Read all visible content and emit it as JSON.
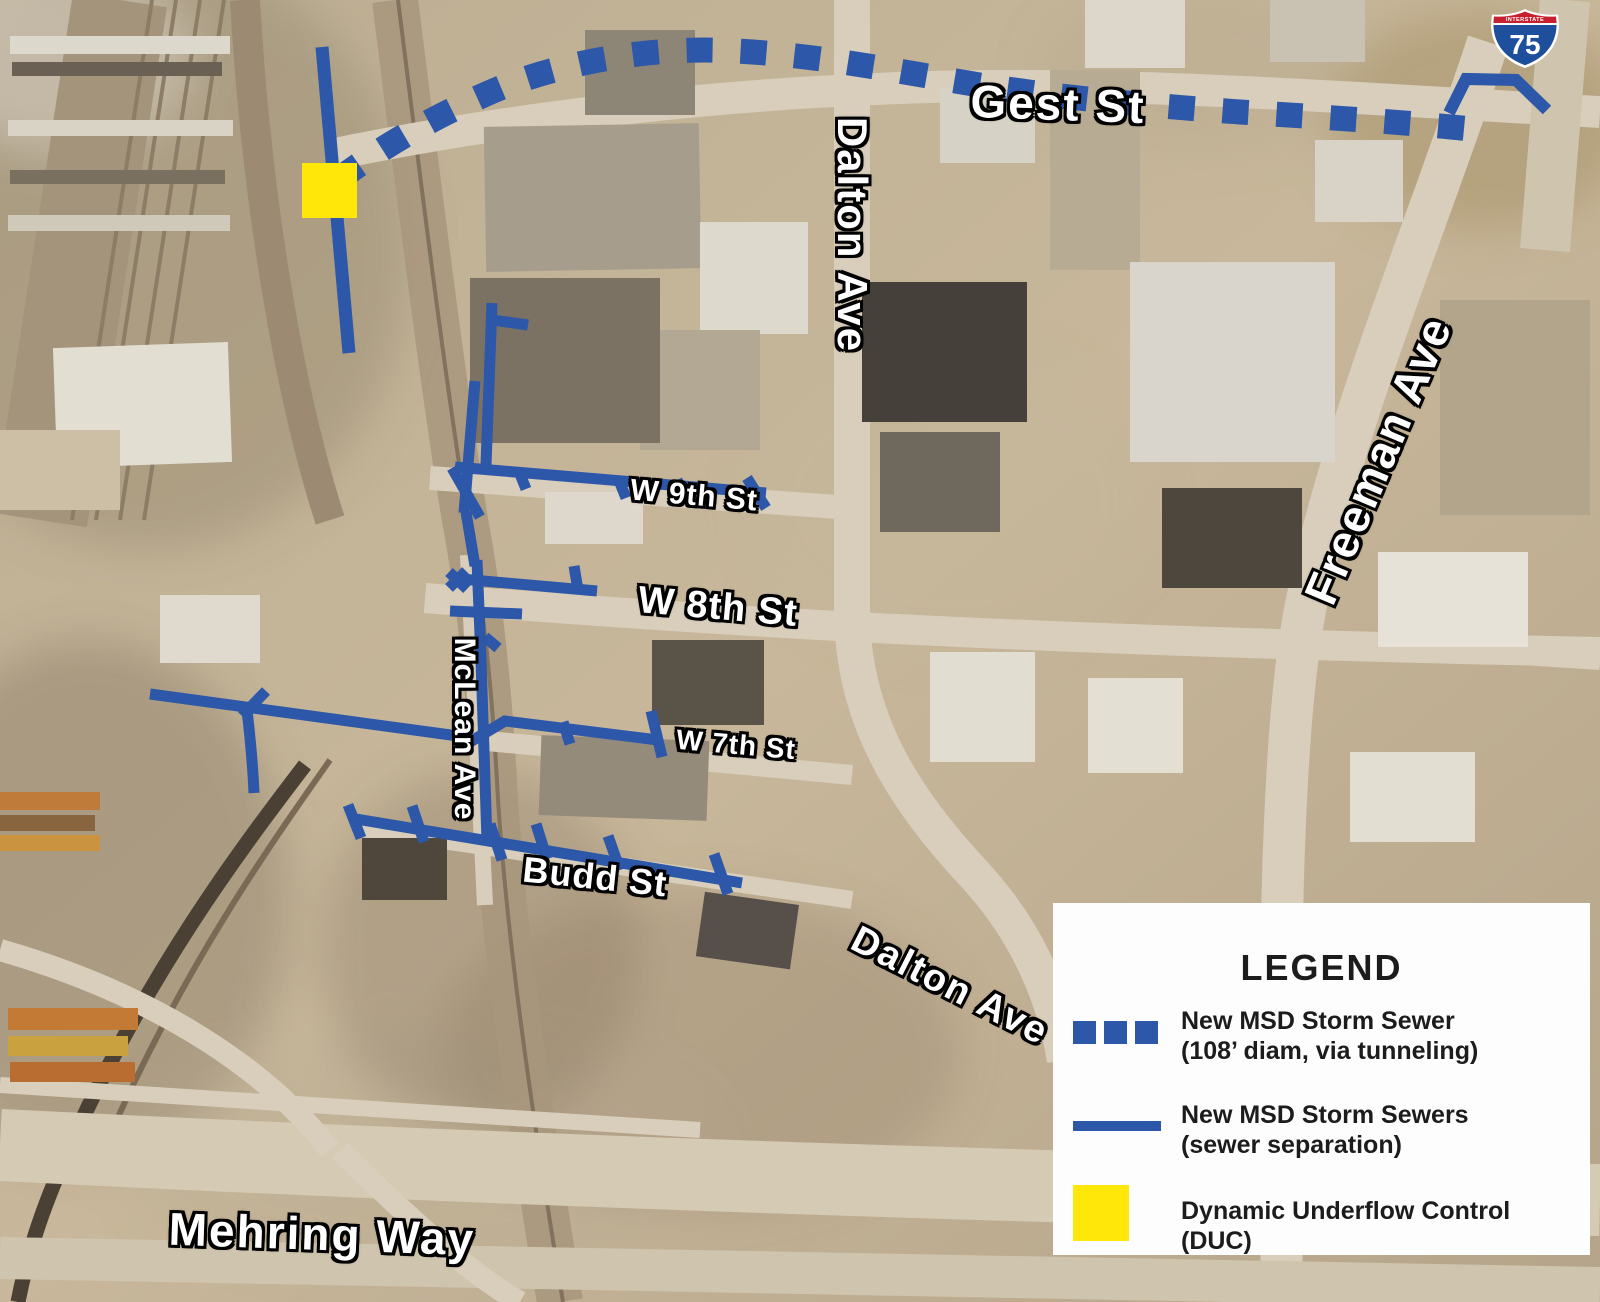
{
  "map": {
    "street_labels": {
      "gest_st": "Gest St",
      "dalton_ave_north": "Dalton Ave",
      "freeman_ave": "Freeman Ave",
      "w_9th_st": "W 9th St",
      "w_8th_st": "W 8th St",
      "w_7th_st": "W 7th St",
      "budd_st": "Budd St",
      "mclean_ave": "McLean Ave",
      "dalton_ave_south": "Dalton Ave",
      "mehring_way": "Mehring Way"
    },
    "interstate_shield": {
      "banner": "INTERSTATE",
      "number": "75"
    }
  },
  "legend": {
    "title": "LEGEND",
    "items": [
      {
        "swatch": "dashed-blue-line",
        "line1": "New MSD Storm Sewer",
        "line2": "(108’ diam, via tunneling)"
      },
      {
        "swatch": "solid-blue-line",
        "line1": "New MSD Storm Sewers",
        "line2": "(sewer separation)"
      },
      {
        "swatch": "yellow-square",
        "line1": "Dynamic Underflow Control",
        "line2": "(DUC)"
      }
    ]
  },
  "colors": {
    "storm_sewer_blue": "#2d57a8",
    "duc_yellow": "#ffe70a",
    "legend_text": "#1c1c1c"
  }
}
